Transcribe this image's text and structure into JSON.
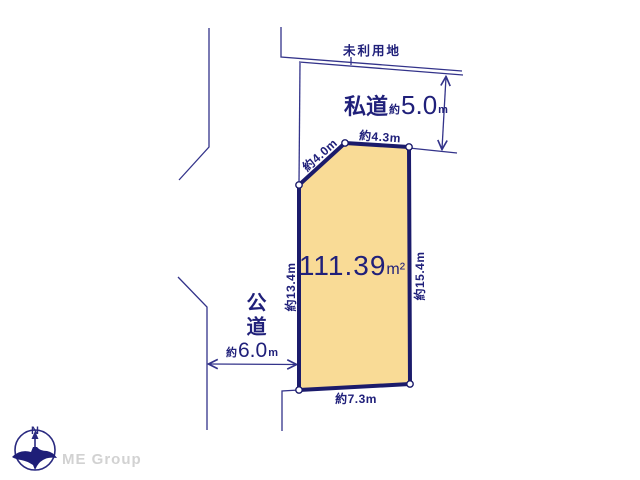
{
  "colors": {
    "parcel_fill": "#f9db96",
    "parcel_border": "#1b1b6b",
    "line_navy": "#33338a",
    "text_navy": "#20207a",
    "brand_gray": "#d2d2d2"
  },
  "diagram": {
    "unused_land_label": "未利用地",
    "private_road": {
      "name": "私道",
      "approx": "約",
      "value": "5.0",
      "unit": "m"
    },
    "public_road": {
      "name": "公道",
      "approx": "約",
      "value": "6.0",
      "unit": "m"
    },
    "parcel": {
      "area_value": "111.39",
      "area_unit": "m²",
      "dim_top": "約4.3m",
      "dim_diagonal": "約4.0m",
      "dim_left": "約13.4m",
      "dim_right": "約15.4m",
      "dim_bottom": "約7.3m"
    }
  },
  "footer": {
    "brand": "ME Group",
    "compass_north": "N"
  }
}
